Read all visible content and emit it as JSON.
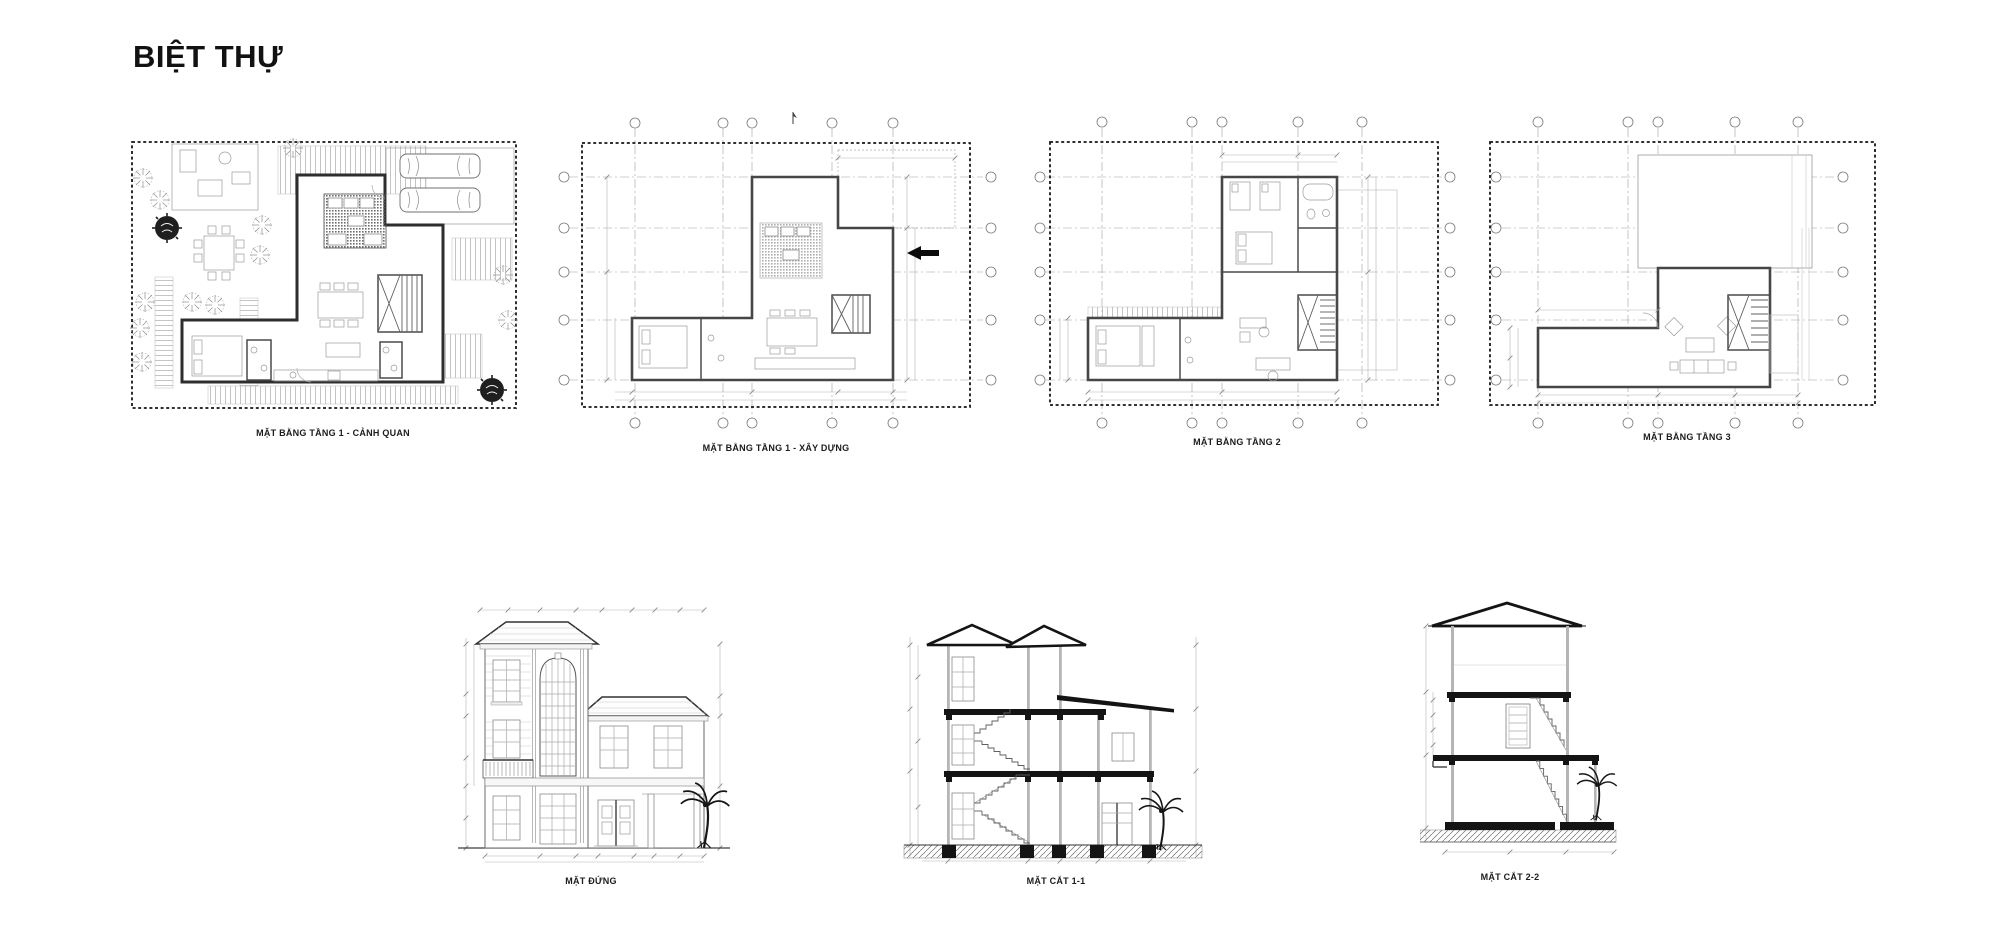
{
  "sheet": {
    "title": "BIỆT THỰ",
    "background": "#ffffff",
    "ink_color": "#141414",
    "line_color": "#8a8a8a",
    "drawing_count": 7
  },
  "drawings": [
    {
      "id": "plan-landscape",
      "label": "MẶT BẰNG TẦNG 1 - CẢNH QUAN",
      "type": "floor-plan"
    },
    {
      "id": "plan-construction",
      "label": "MẶT BẰNG TẦNG 1  - XÂY DỰNG",
      "type": "floor-plan"
    },
    {
      "id": "plan-level2",
      "label": "MẶT BẰNG TẦNG 2",
      "type": "floor-plan"
    },
    {
      "id": "plan-level3",
      "label": "MẶT BẰNG TẦNG 3",
      "type": "floor-plan"
    },
    {
      "id": "elevation-front",
      "label": "MẶT ĐỨNG",
      "type": "elevation"
    },
    {
      "id": "section-1-1",
      "label": "MẶT CẮT 1-1",
      "type": "section"
    },
    {
      "id": "section-2-2",
      "label": "MẶT CẮT 2-2",
      "type": "section"
    }
  ]
}
